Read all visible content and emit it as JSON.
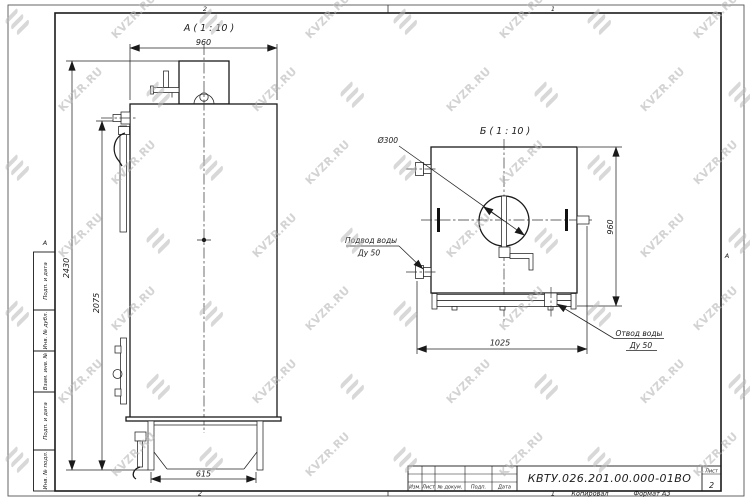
{
  "watermark": {
    "text": "KVZR.RU"
  },
  "border": {
    "top": [
      "2",
      "1"
    ],
    "bottom": [
      "2",
      "1"
    ],
    "left_row": "А",
    "right_row": "А"
  },
  "footer": {
    "copied_label": "Копировал",
    "format_label": "Формат А3"
  },
  "side_stamps": [
    "Подп. и дата",
    "Инв. № дубл.",
    "Взам. инв. №",
    "Подп. и дата",
    "Инв. № подл."
  ],
  "title_block": {
    "col_izm": "Изм.",
    "col_list": "Лист",
    "col_doc": "№ докум.",
    "col_sign": "Подп.",
    "col_date": "Дата",
    "designation": "КВТУ.026.201.00.000-01ВО",
    "sheet_label": "Лист",
    "sheet_value": "2"
  },
  "view_a": {
    "title": "А ( 1 : 10 )",
    "dim_width": "960",
    "dim_height_total": "2430",
    "dim_height_door": "2075",
    "dim_base": "615"
  },
  "view_b": {
    "title": "Б ( 1 : 10 )",
    "dim_diameter": "Ø300",
    "dim_height": "960",
    "dim_width": "1025",
    "inlet_label_1": "Подвод воды",
    "inlet_label_2": "Ду 50",
    "outlet_label_1": "Отвод воды",
    "outlet_label_2": "Ду 50"
  }
}
